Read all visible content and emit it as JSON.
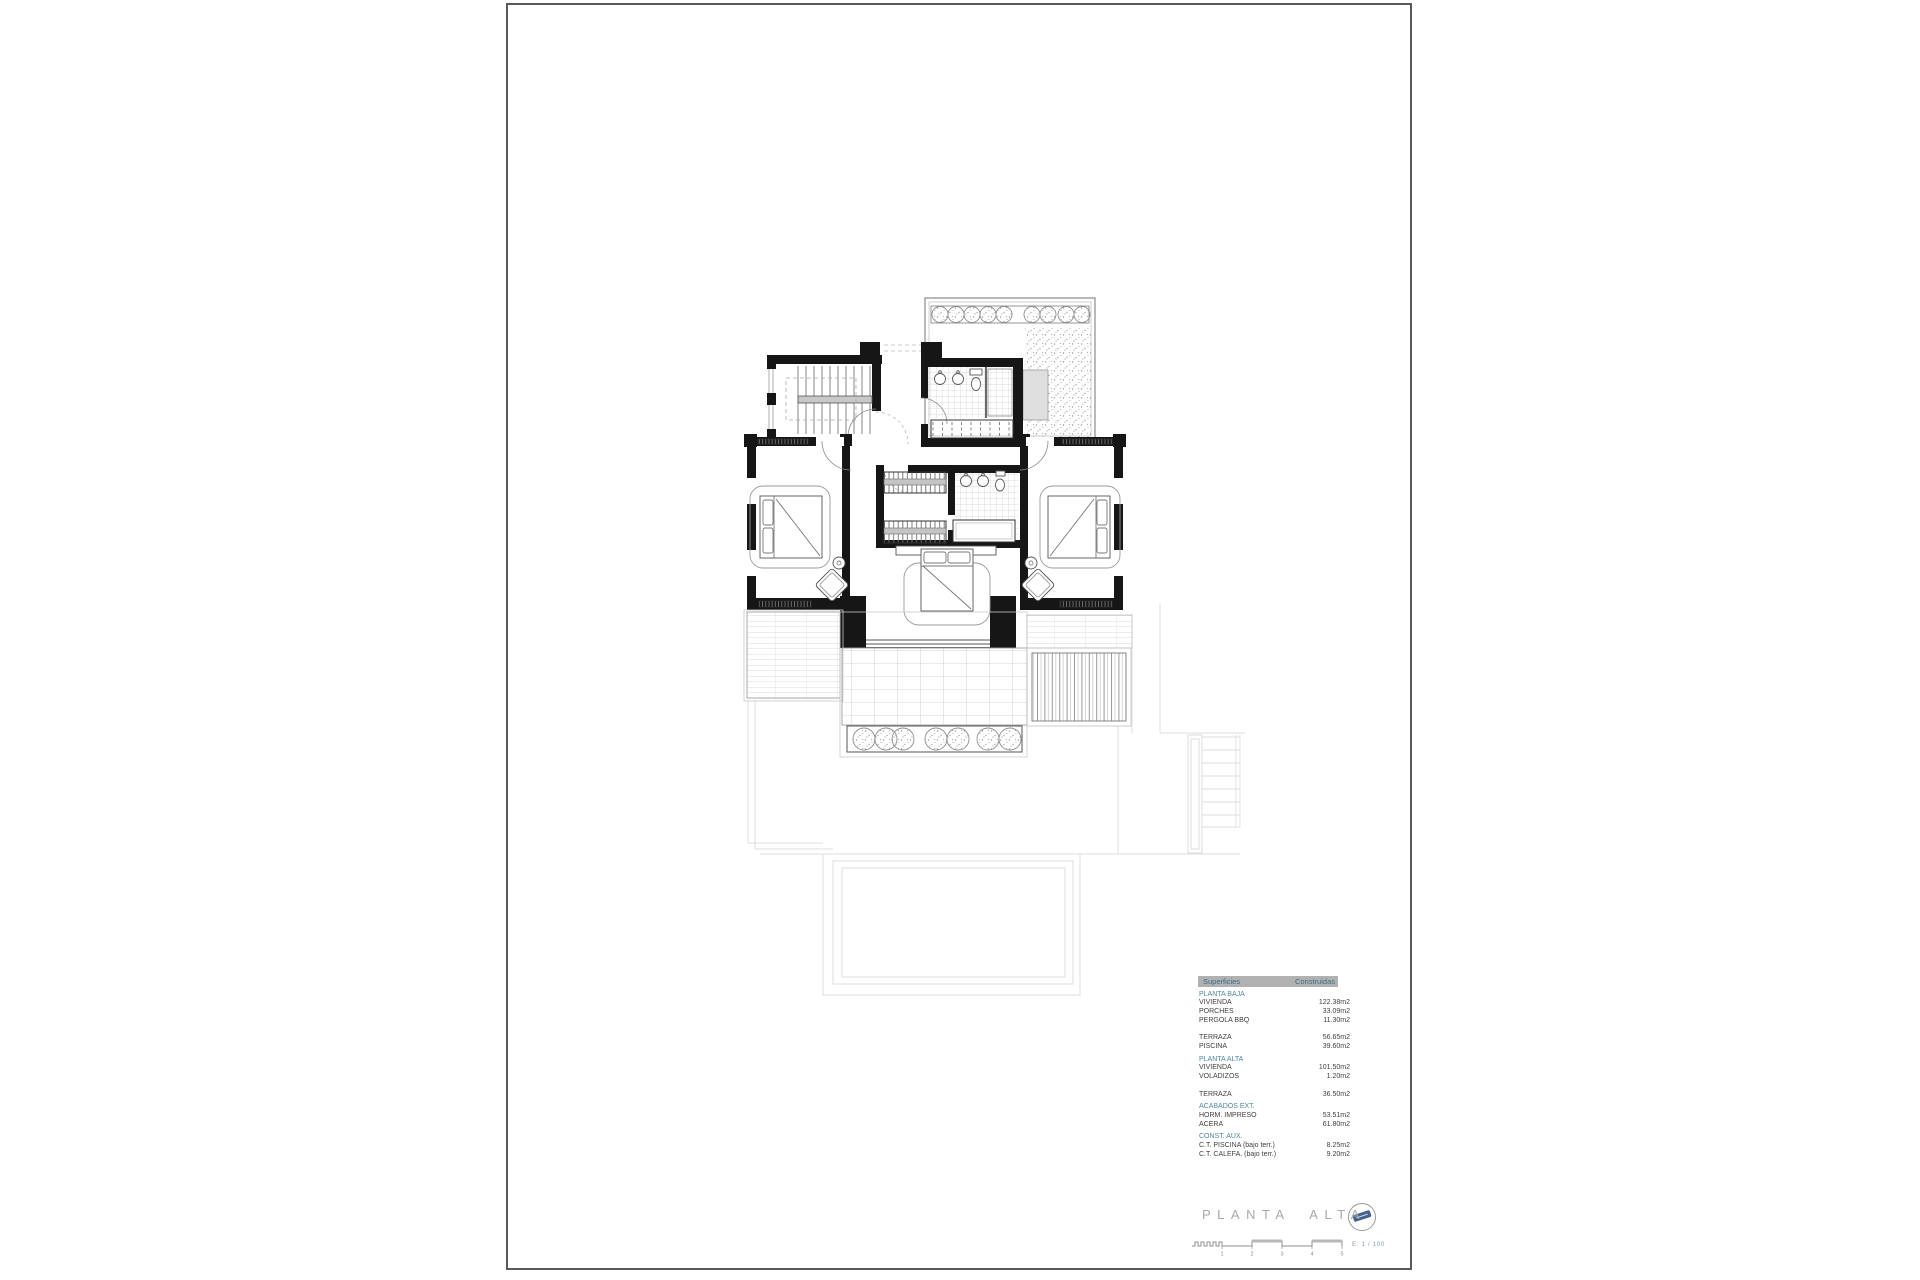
{
  "areas_table": {
    "header": {
      "col1": "Superficies",
      "col2": "Construidas"
    },
    "rows": [
      {
        "type": "section",
        "label": "PLANTA BAJA"
      },
      {
        "type": "item",
        "label": "VIVIENDA",
        "value": "122.38m2"
      },
      {
        "type": "item",
        "label": "PORCHES",
        "value": "33.09m2"
      },
      {
        "type": "item",
        "label": "PERGOLA BBQ",
        "value": "11.30m2"
      },
      {
        "type": "spacer"
      },
      {
        "type": "item",
        "label": "TERRAZA",
        "value": "56.65m2"
      },
      {
        "type": "item",
        "label": "PISCINA",
        "value": "39.60m2"
      },
      {
        "type": "section",
        "label": "PLANTA ALTA"
      },
      {
        "type": "item",
        "label": "VIVIENDA",
        "value": "101.50m2"
      },
      {
        "type": "item",
        "label": "VOLADIZOS",
        "value": "1.20m2"
      },
      {
        "type": "spacer"
      },
      {
        "type": "item",
        "label": "TERRAZA",
        "value": "36.50m2"
      },
      {
        "type": "section",
        "label": "ACABADOS EXT."
      },
      {
        "type": "item",
        "label": "HORM. IMPRESO",
        "value": "53.51m2"
      },
      {
        "type": "item",
        "label": "ACERA",
        "value": "61.80m2"
      },
      {
        "type": "section",
        "label": "CONST. AUX."
      },
      {
        "type": "item",
        "label": "C.T. PISCINA (bajo terr.)",
        "value": "8.25m2"
      },
      {
        "type": "item",
        "label": "C.T. CALEFA. (bajo terr.)",
        "value": "9.20m2"
      }
    ]
  },
  "titleblock": {
    "title": "PLANTA ALTA",
    "scale_text": "E: 1 / 100",
    "scale_numbers": [
      "1",
      "2",
      "3",
      "4",
      "5"
    ],
    "logo_icon": "circle-logo"
  },
  "colors": {
    "accent_teal": "#4d87a1",
    "table_header_bg": "#b1b1b1",
    "table_text": "#3f3f3f",
    "wall_black": "#161616",
    "faint_groundfloor": "#dcdcdc",
    "title_gray": "#a9a9a9",
    "scale_text_blue": "#8ba1b4"
  }
}
